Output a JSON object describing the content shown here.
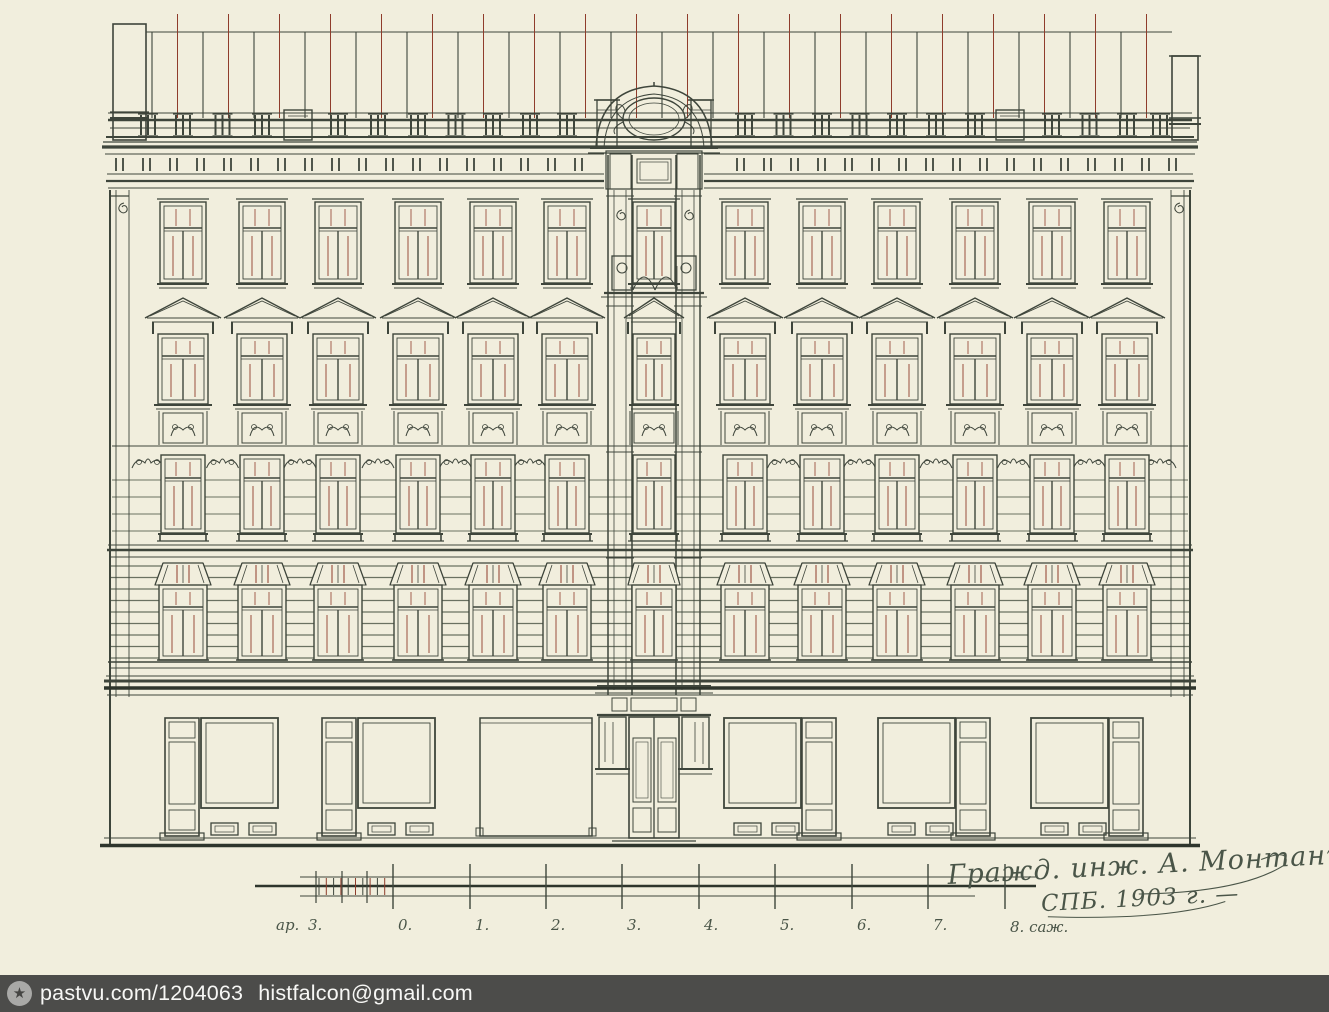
{
  "drawing": {
    "type": "architectural-elevation",
    "paper_color": "#f1eedd",
    "ink_color": "#3e453b",
    "ink_dark": "#2e352c",
    "ink_light": "#6a7161",
    "accent_red": "#8f3c2b",
    "floors": 5,
    "window_columns": 13
  },
  "scale_bar": {
    "left_unit_label": "ар.",
    "left_value_label": "3.",
    "tick_labels": [
      "0.",
      "1.",
      "2.",
      "3.",
      "4.",
      "5.",
      "6.",
      "7."
    ],
    "end_label": "8. саж."
  },
  "signature": {
    "line1": "Гражд. инж. А. Монтанъ",
    "line2": "СПБ. 1903 г. —"
  },
  "watermark": {
    "icon": "star-icon",
    "site": "pastvu.com/1204063",
    "email": "histfalcon@gmail.com",
    "bar_color": "#4c4c4a",
    "text_color": "#f7f7f5"
  }
}
